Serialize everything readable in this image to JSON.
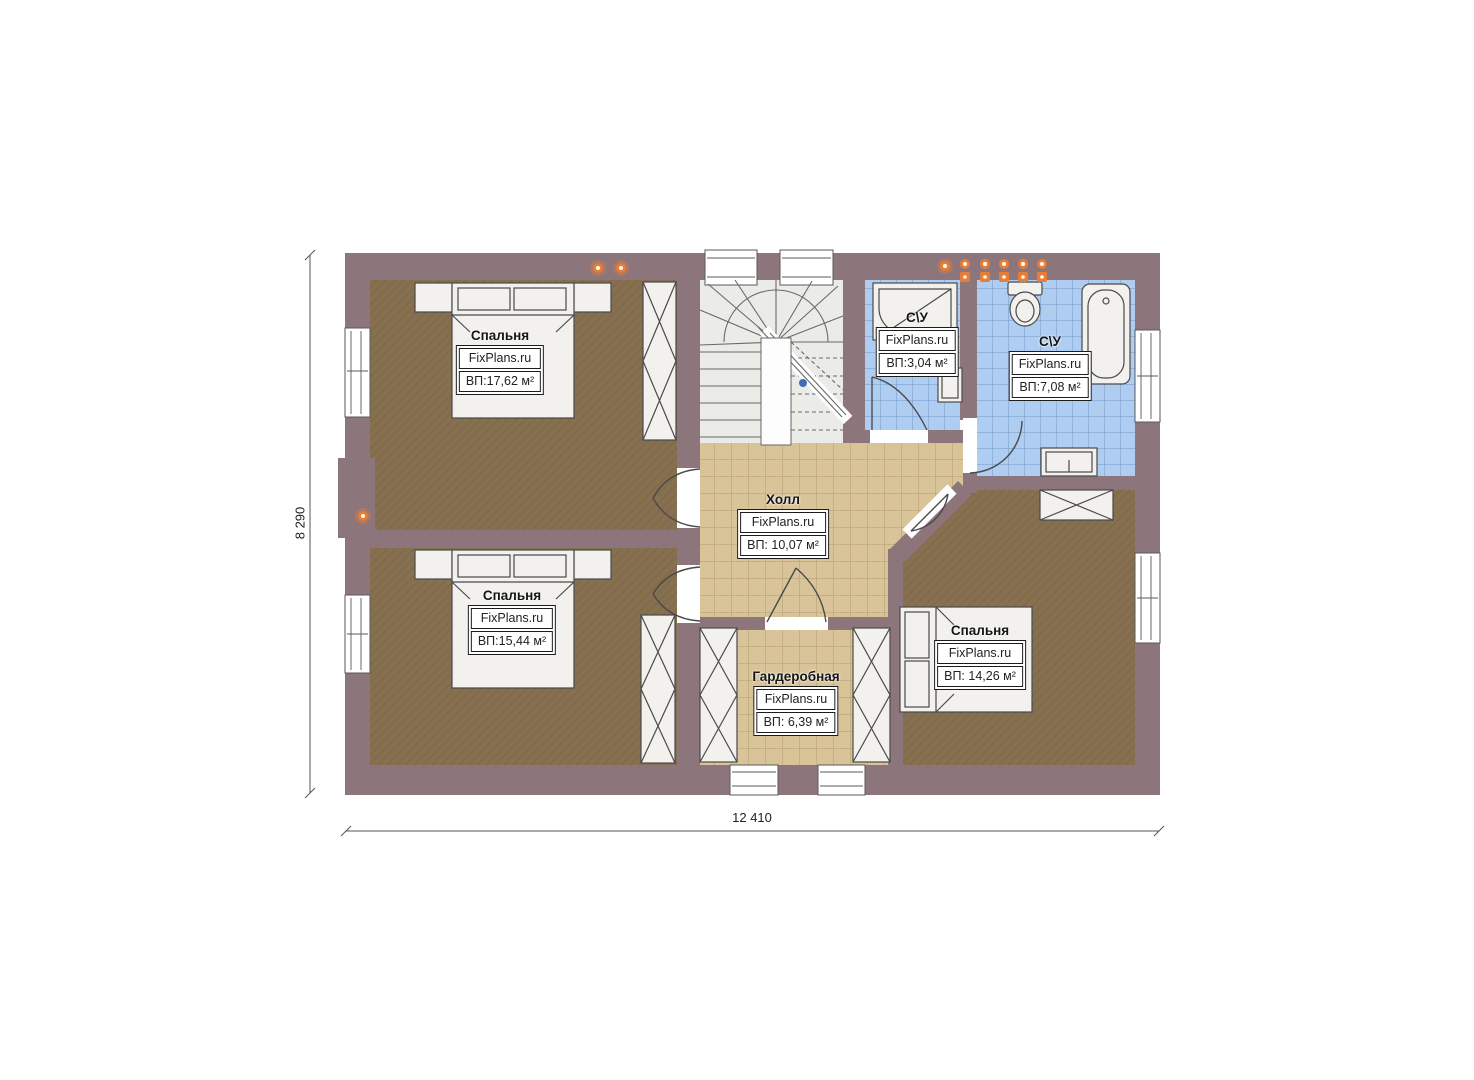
{
  "colors": {
    "wall": "#8d767b",
    "bedroom_floor": "#86704f",
    "hall_floor": "#d9c499",
    "hall_grid": "#b49a6e",
    "bath_floor": "#aecdf1",
    "bath_grid": "#7396c9",
    "stair_floor": "#ebebe7",
    "fixture": "#f2f1ed",
    "outline": "#4a4a4a",
    "lamp": "#e87d33",
    "marker_blue": "#3f6db5"
  },
  "dimensions": {
    "height_label": "8 290",
    "width_label": "12 410"
  },
  "rooms": [
    {
      "id": "bedroom-top-left",
      "name": "Спальня",
      "brand": "FixPlans.ru",
      "area": "ВП:17,62 м²"
    },
    {
      "id": "bedroom-bottom-left",
      "name": "Спальня",
      "brand": "FixPlans.ru",
      "area": "ВП:15,44 м²"
    },
    {
      "id": "hall",
      "name": "Холл",
      "brand": "FixPlans.ru",
      "area": "ВП: 10,07 м²"
    },
    {
      "id": "bathroom-small",
      "name": "С\\У",
      "brand": "FixPlans.ru",
      "area": "ВП:3,04 м²"
    },
    {
      "id": "bathroom-large",
      "name": "С\\У",
      "brand": "FixPlans.ru",
      "area": "ВП:7,08 м²"
    },
    {
      "id": "bedroom-bottom-right",
      "name": "Спальня",
      "brand": "FixPlans.ru",
      "area": "ВП: 14,26 м²"
    },
    {
      "id": "wardrobe",
      "name": "Гардеробная",
      "brand": "FixPlans.ru",
      "area": "ВП: 6,39 м²"
    }
  ]
}
